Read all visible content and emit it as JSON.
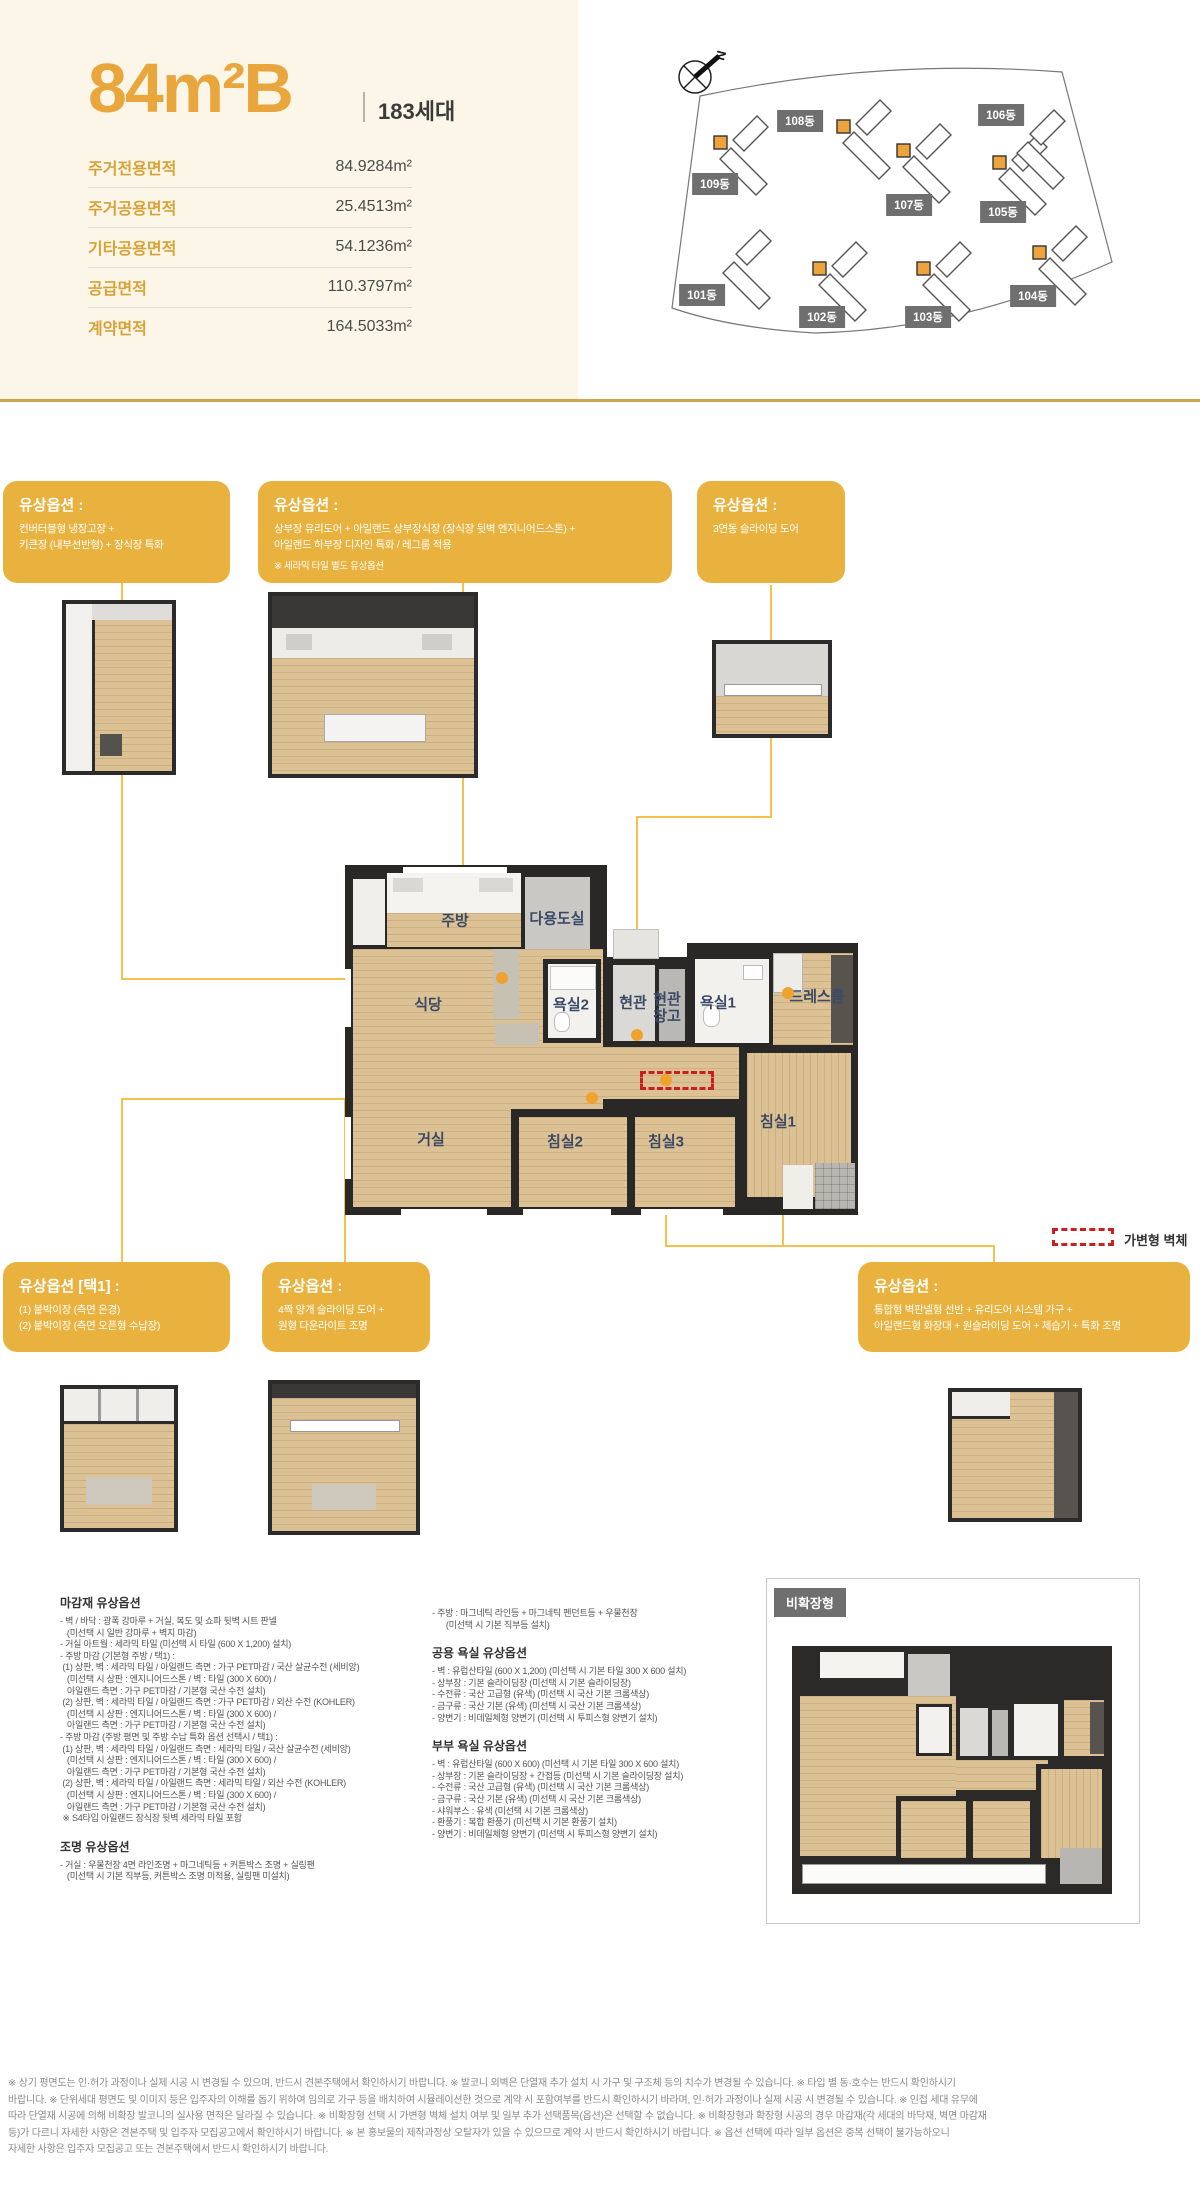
{
  "colors": {
    "accent_gold": "#E9A63D",
    "option_box": "#E9B23E",
    "leader": "#F3C14E",
    "badge_gray": "#6F6F6F",
    "cream": "#FBF6E7",
    "red_dash": "#CB1F1F",
    "wood": "#DCC194",
    "wall": "#2A2826"
  },
  "unit": {
    "title": "84m²B",
    "households": "183세대"
  },
  "area_table": {
    "rows": [
      {
        "label": "주거전용면적",
        "value": "84.9284m²"
      },
      {
        "label": "주거공용면적",
        "value": "25.4513m²"
      },
      {
        "label": "기타공용면적",
        "value": "54.1236m²"
      },
      {
        "label": "공급면적",
        "value": "110.3797m²"
      },
      {
        "label": "계약면적",
        "value": "164.5033m²"
      }
    ]
  },
  "site_plan": {
    "north_label": "N",
    "buildings": [
      {
        "label": "101동",
        "x": 702,
        "y": 295
      },
      {
        "label": "102동",
        "x": 822,
        "y": 317
      },
      {
        "label": "103동",
        "x": 928,
        "y": 317
      },
      {
        "label": "104동",
        "x": 1033,
        "y": 296
      },
      {
        "label": "105동",
        "x": 1003,
        "y": 212
      },
      {
        "label": "106동",
        "x": 1001,
        "y": 115
      },
      {
        "label": "107동",
        "x": 909,
        "y": 205
      },
      {
        "label": "108동",
        "x": 800,
        "y": 121
      },
      {
        "label": "109동",
        "x": 715,
        "y": 184
      }
    ]
  },
  "options": {
    "box1": {
      "title": "유상옵션 :",
      "lines": [
        "컨버터블형 냉장고장 +",
        "키큰장 (내부선반형) + 장식장 특화"
      ]
    },
    "box2": {
      "title": "유상옵션 :",
      "lines": [
        "상부장 유리도어 + 아일랜드 상부장식장 (장식장 뒷벽 엔지니어드스톤) +",
        "아일랜드 하부장 디자인 특화 / 레그룸 적용"
      ],
      "note": "※ 세라믹 타일 별도 유상옵션"
    },
    "box3": {
      "title": "유상옵션 :",
      "lines": [
        "3연동 슬라이딩 도어"
      ]
    },
    "box4": {
      "title": "유상옵션 [택1] :",
      "lines": [
        "(1) 붙박이장 (측면 은경)",
        "(2) 붙박이장 (측면 오픈형 수납장)"
      ]
    },
    "box5": {
      "title": "유상옵션 :",
      "lines": [
        "4짝 양개 슬라이딩 도어 +",
        "원형 다운라이트 조명"
      ]
    },
    "box6": {
      "title": "유상옵션 :",
      "lines": [
        "통합형 벽판넬형 선반 + 유리도어 시스템 가구 +",
        "아일랜드형 화장대 + 원슬라이딩 도어 + 제습기 + 특화 조명"
      ]
    }
  },
  "plan": {
    "rooms": [
      {
        "label": "주방",
        "x": 455,
        "y": 921
      },
      {
        "label": "다용도실",
        "x": 557,
        "y": 919
      },
      {
        "label": "식당",
        "x": 428,
        "y": 1005
      },
      {
        "label": "욕실2",
        "x": 571,
        "y": 1005
      },
      {
        "label": "현관",
        "x": 633,
        "y": 1003
      },
      {
        "label": "현관창고",
        "x": 667,
        "y": 1008,
        "w": 36
      },
      {
        "label": "욕실1",
        "x": 718,
        "y": 1003
      },
      {
        "label": "드레스룸",
        "x": 817,
        "y": 997
      },
      {
        "label": "거실",
        "x": 431,
        "y": 1140
      },
      {
        "label": "침실2",
        "x": 565,
        "y": 1142
      },
      {
        "label": "침실3",
        "x": 666,
        "y": 1142
      },
      {
        "label": "침실1",
        "x": 778,
        "y": 1122
      }
    ],
    "legend": {
      "label": "가변형 벽체"
    }
  },
  "specs": {
    "finish": {
      "title": "마감재 유상옵션",
      "lines": [
        "- 벽 / 바닥 : 광폭 강마루 + 거실, 복도 및 쇼파 뒷벽 시트 판넬",
        "   (미선택 시 일반 강마루 + 벽지 마감)",
        "- 거실 아트월 : 세라믹 타일 (미선택 시 타일 (600 X 1,200) 설치)",
        "- 주방 마감 (기본형 주방 / 택1) :",
        " (1) 상판, 벽 : 세라믹 타일 / 아일랜드 측면 : 가구 PET마감 / 국산 살균수전 (세비앙)",
        "   (미선택 시 상판 : 엔지니어드스톤 / 벽 : 타일 (300 X 600) /",
        "   아일랜드 측면 : 가구 PET마감 / 기본형 국산 수전 설치)",
        " (2) 상판, 벽 : 세라믹 타일 / 아일랜드 측면 : 가구 PET마감 / 외산 수전 (KOHLER)",
        "   (미선택 시 상판 : 엔지니어드스톤 / 벽 : 타일 (300 X 600) /",
        "   아일랜드 측면 : 가구 PET마감 / 기본형 국산 수전 설치)",
        "- 주방 마감 (주방 평면 및 주방 수납 특화 옵션 선택시 / 택1) :",
        " (1) 상판, 벽 : 세라믹 타일 / 아일랜드 측면 : 세라믹 타일 / 국산 살균수전 (세비앙)",
        "   (미선택 시 상판 : 엔지니어드스톤 / 벽 : 타일 (300 X 600) /",
        "   아일랜드 측면 : 가구 PET마감 / 기본형 국산 수전 설치)",
        " (2) 상판, 벽 : 세라믹 타일 / 아일랜드 측면 : 세라믹 타일 / 외산 수전 (KOHLER)",
        "   (미선택 시 상판 : 엔지니어드스톤 / 벽 : 타일 (300 X 600) /",
        "   아일랜드 측면 : 가구 PET마감 / 기본형 국산 수전 설치)",
        " ※ S4타입 아일랜드 장식장 뒷벽 세라믹 타일 포함"
      ]
    },
    "lighting": {
      "title": "조명 유상옵션",
      "lines": [
        "- 거실 : 우물천장 4면 라인조명 + 마그네틱등 + 커튼박스 조명 + 실링팬",
        "   (미선택 시 기본 직부등, 커튼박스 조명 미적용, 실링팬 미설치)"
      ]
    },
    "kitchen_lighting": {
      "lines": [
        "- 주방 : 마그네틱 라인등 + 마그네틱 펜던트등 + 우물천장",
        "      (미선택 시 기본 직부등 설치)"
      ]
    },
    "common_bath": {
      "title": "공용 욕실 유상옵션",
      "lines": [
        "- 벽 : 유럽산타일 (600 X 1,200) (미선택 시 기본 타일 300 X 600 설치)",
        "- 상부장 : 기본 슬라이딩장 (미선택 시 기본 슬라이딩장)",
        "- 수전류 : 국산 고급형 (유색) (미선택 시 국산 기본 크롬색상)",
        "- 금구류 : 국산 기본 (유색) (미선택 시 국산 기본 크롬색상)",
        "- 양변기 : 비데일체형 양변기 (미선택 시 투피스형 양변기 설치)"
      ]
    },
    "master_bath": {
      "title": "부부 욕실 유상옵션",
      "lines": [
        "- 벽 : 유럽산타일 (600 X 600) (미선택 시 기본 타일 300 X 600 설치)",
        "- 상부장 : 기본 슬라이딩장 + 간접등 (미선택 시 기본 슬라이딩장 설치)",
        "- 수전류 : 국산 고급형 (유색) (미선택 시 국산 기본 크롬색상)",
        "- 금구류 : 국산 기본 (유색) (미선택 시 국산 기본 크롬색상)",
        "- 샤워부스 : 유색 (미선택 시 기본 크롬색상)",
        "- 환풍기 : 복합 환풍기 (미선택 시 기본 환풍기 설치)",
        "- 양변기 : 비데일체형 양변기 (미선택 시 투피스형 양변기 설치)"
      ]
    }
  },
  "nonexpanded": {
    "label": "비확장형"
  },
  "footer": {
    "lines": [
      "※ 상기 평면도는 인·허가 과정이나 실제 시공 시 변경될 수 있으며, 반드시 견본주택에서 확인하시기 바랍니다. ※ 발코니 외벽은 단열재 추가 설치 시 가구 및 구조체 등의 치수가 변경될 수 있습니다. ※ 타입 별 동·호수는 반드시 확인하시기",
      "바랍니다. ※ 단위세대 평면도 및 이미지 등은 입주자의 이해를 돕기 위하여 임의로 가구 등을 배치하여 시뮬레이션한 것으로 계약 시 포함여부를 반드시 확인하시기 바라며, 인·허가 과정이나 실제 시공 시 변경될 수 있습니다. ※ 인접 세대 유무에",
      "따라 단열재 시공에 의해 비확장 발코니의 실사용 면적은 달라질 수 있습니다. ※ 비확장형 선택 시 가변형 벽체 설치 여부 및 일부 추가 선택품목(옵션)은 선택할 수 없습니다. ※ 비확장형과 확장형 시공의 경우 마감재(각 세대의 바닥재, 벽면 마감재",
      "등)가 다르니 자세한 사항은 견본주택 및 입주자 모집공고에서 확인하시기 바랍니다. ※ 본 홍보물의 제작과정상 오탈자가 있을 수 있으므로 계약 시 반드시 확인하시기 바랍니다. ※ 옵션 선택에 따라 일부 옵션은 중복 선택이 불가능하오니",
      "자세한 사항은 입주자 모집공고 또는 견본주택에서 반드시 확인하시기 바랍니다."
    ]
  }
}
